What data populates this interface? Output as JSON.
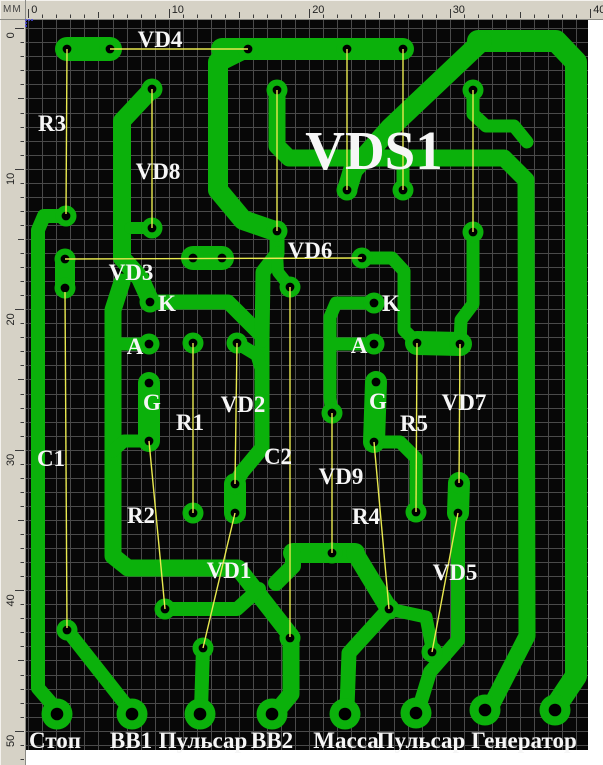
{
  "ruler": {
    "unit": "MM",
    "bg": "#d6d2c6",
    "tick_color": "#3a3a3a",
    "origin_px": 28.2,
    "px_per_mm": 14.05,
    "top_strip_h": 20,
    "left_strip_w": 26,
    "top_marks": [
      0,
      10,
      20,
      30,
      40
    ],
    "left_marks": [
      0,
      10,
      20,
      30,
      40,
      50
    ],
    "top_minor_count": 40,
    "left_minor_count": 52
  },
  "board": {
    "x": 26,
    "y": 20,
    "w": 562,
    "h": 730,
    "bg": "#070707",
    "grid_color": "#4a4a4a",
    "origin_marker_color": "#4646e8"
  },
  "colors": {
    "copper": "#0bb10b",
    "hole": "#000000",
    "ratsnest": "#e9e94f",
    "label": "#f6f6f6"
  },
  "pcb": {
    "title": {
      "text": "VDS1",
      "x": 374,
      "y": 169,
      "size": 55
    },
    "labels": [
      {
        "text": "VD4",
        "x": 160,
        "y": 47
      },
      {
        "text": "R3",
        "x": 52,
        "y": 131
      },
      {
        "text": "VD8",
        "x": 158,
        "y": 179
      },
      {
        "text": "VD3",
        "x": 131,
        "y": 280
      },
      {
        "text": "VD6",
        "x": 310,
        "y": 258
      },
      {
        "text": "K",
        "x": 167,
        "y": 311
      },
      {
        "text": "K",
        "x": 391,
        "y": 311
      },
      {
        "text": "A",
        "x": 135,
        "y": 354
      },
      {
        "text": "A",
        "x": 359,
        "y": 353
      },
      {
        "text": "G",
        "x": 152,
        "y": 410
      },
      {
        "text": "G",
        "x": 378,
        "y": 409
      },
      {
        "text": "R1",
        "x": 190,
        "y": 430
      },
      {
        "text": "VD2",
        "x": 243,
        "y": 412
      },
      {
        "text": "R5",
        "x": 414,
        "y": 431
      },
      {
        "text": "VD7",
        "x": 464,
        "y": 410
      },
      {
        "text": "C1",
        "x": 51,
        "y": 466
      },
      {
        "text": "C2",
        "x": 278,
        "y": 464
      },
      {
        "text": "VD9",
        "x": 341,
        "y": 484
      },
      {
        "text": "R2",
        "x": 141,
        "y": 523
      },
      {
        "text": "R4",
        "x": 366,
        "y": 524
      },
      {
        "text": "VD1",
        "x": 229,
        "y": 578
      },
      {
        "text": "VD5",
        "x": 455,
        "y": 580
      }
    ],
    "connector_labels": [
      {
        "text": "Стоп",
        "x": 55,
        "y": 748
      },
      {
        "text": "BB1",
        "x": 131,
        "y": 748
      },
      {
        "text": "Пульсар",
        "x": 203,
        "y": 748
      },
      {
        "text": "BB2",
        "x": 272,
        "y": 748
      },
      {
        "text": "Масса",
        "x": 346,
        "y": 748
      },
      {
        "text": "Пульсар",
        "x": 421,
        "y": 748
      },
      {
        "text": "Генератор",
        "x": 524,
        "y": 748
      }
    ],
    "pads": [
      [
        67,
        49
      ],
      [
        110,
        49
      ],
      [
        248,
        49
      ],
      [
        347,
        49
      ],
      [
        403,
        49
      ],
      [
        152,
        89
      ],
      [
        277,
        90
      ],
      [
        473,
        90
      ],
      [
        347,
        190
      ],
      [
        403,
        190
      ],
      [
        66,
        216
      ],
      [
        152,
        228
      ],
      [
        277,
        231
      ],
      [
        473,
        232
      ],
      [
        65,
        259
      ],
      [
        65,
        288
      ],
      [
        193,
        258
      ],
      [
        222,
        258
      ],
      [
        362,
        258
      ],
      [
        290,
        287
      ],
      [
        150,
        302
      ],
      [
        374,
        303
      ],
      [
        149,
        344
      ],
      [
        193,
        343
      ],
      [
        237,
        343
      ],
      [
        374,
        344
      ],
      [
        417,
        343
      ],
      [
        460,
        344
      ],
      [
        149,
        383
      ],
      [
        376,
        382
      ],
      [
        332,
        413
      ],
      [
        149,
        441
      ],
      [
        374,
        442
      ],
      [
        235,
        484
      ],
      [
        459,
        483
      ],
      [
        193,
        513
      ],
      [
        235,
        513
      ],
      [
        416,
        512
      ],
      [
        458,
        513
      ],
      [
        332,
        553
      ],
      [
        165,
        609
      ],
      [
        389,
        609
      ],
      [
        67,
        630
      ],
      [
        203,
        648
      ],
      [
        290,
        638
      ],
      [
        432,
        652
      ]
    ],
    "pad_r": 10.5,
    "pad_hole_r": 4.4,
    "big_pads": [
      [
        57,
        714
      ],
      [
        132,
        714
      ],
      [
        200,
        714
      ],
      [
        272,
        714
      ],
      [
        345,
        714
      ],
      [
        416,
        713
      ],
      [
        485,
        710
      ],
      [
        555,
        710
      ]
    ],
    "big_pad_r": 15.5,
    "big_pad_hole_r": 6.3,
    "traces": [
      {
        "p": [
          [
            67,
            49
          ],
          [
            110,
            49
          ]
        ],
        "w": 24
      },
      {
        "p": [
          [
            403,
            49
          ],
          [
            222,
            49
          ]
        ],
        "w": 22
      },
      {
        "p": [
          [
            244,
            49
          ],
          [
            218,
            62
          ],
          [
            218,
            190
          ],
          [
            243,
            220
          ],
          [
            272,
            230
          ]
        ],
        "w": 20
      },
      {
        "p": [
          [
            152,
            89
          ],
          [
            122,
            121
          ],
          [
            122,
            258
          ],
          [
            140,
            278
          ],
          [
            150,
            300
          ]
        ],
        "w": 18
      },
      {
        "p": [
          [
            122,
            282
          ],
          [
            113,
            310
          ],
          [
            113,
            556
          ],
          [
            128,
            568
          ],
          [
            238,
            568
          ],
          [
            291,
            636
          ],
          [
            291,
            694
          ],
          [
            277,
            711
          ]
        ],
        "w": 17
      },
      {
        "p": [
          [
            113,
            344
          ],
          [
            149,
            344
          ]
        ],
        "w": 13
      },
      {
        "p": [
          [
            149,
            441
          ],
          [
            124,
            441
          ],
          [
            113,
            451
          ]
        ],
        "w": 13
      },
      {
        "p": [
          [
            149,
            383
          ],
          [
            149,
            441
          ]
        ],
        "w": 22
      },
      {
        "p": [
          [
            376,
            382
          ],
          [
            374,
            442
          ]
        ],
        "w": 22
      },
      {
        "p": [
          [
            66,
            216
          ],
          [
            44,
            216
          ],
          [
            38,
            230
          ],
          [
            38,
            688
          ],
          [
            57,
            710
          ]
        ],
        "w": 14
      },
      {
        "p": [
          [
            65,
            259
          ],
          [
            65,
            288
          ]
        ],
        "w": 20
      },
      {
        "p": [
          [
            193,
            258
          ],
          [
            222,
            258
          ]
        ],
        "w": 24
      },
      {
        "p": [
          [
            152,
            228
          ],
          [
            130,
            228
          ]
        ],
        "w": 12
      },
      {
        "p": [
          [
            150,
            302
          ],
          [
            228,
            302
          ],
          [
            262,
            336
          ],
          [
            262,
            448
          ],
          [
            242,
            472
          ],
          [
            235,
            484
          ]
        ],
        "w": 15
      },
      {
        "p": [
          [
            277,
            231
          ],
          [
            277,
            254
          ],
          [
            263,
            272
          ],
          [
            262,
            340
          ]
        ],
        "w": 15
      },
      {
        "p": [
          [
            290,
            287
          ],
          [
            278,
            272
          ],
          [
            277,
            252
          ]
        ],
        "w": 12
      },
      {
        "p": [
          [
            237,
            343
          ],
          [
            257,
            355
          ],
          [
            262,
            372
          ]
        ],
        "w": 13
      },
      {
        "p": [
          [
            235,
            484
          ],
          [
            235,
            513
          ]
        ],
        "w": 22
      },
      {
        "p": [
          [
            277,
            90
          ],
          [
            277,
            146
          ],
          [
            289,
            158
          ],
          [
            504,
            158
          ],
          [
            526,
            180
          ],
          [
            527,
            636
          ],
          [
            492,
            704
          ]
        ],
        "w": 17
      },
      {
        "p": [
          [
            473,
            90
          ],
          [
            473,
            114
          ],
          [
            486,
            126
          ],
          [
            514,
            126
          ],
          [
            527,
            142
          ]
        ],
        "w": 13
      },
      {
        "p": [
          [
            478,
            41
          ],
          [
            556,
            41
          ],
          [
            576,
            62
          ],
          [
            576,
            676
          ],
          [
            558,
            703
          ]
        ],
        "w": 22
      },
      {
        "p": [
          [
            482,
            41
          ],
          [
            390,
            128
          ],
          [
            353,
            170
          ],
          [
            347,
            190
          ]
        ],
        "w": 20
      },
      {
        "p": [
          [
            403,
            190
          ],
          [
            403,
            158
          ]
        ],
        "w": 13
      },
      {
        "p": [
          [
            362,
            258
          ],
          [
            392,
            258
          ],
          [
            404,
            271
          ],
          [
            404,
            330
          ],
          [
            417,
            343
          ]
        ],
        "w": 13
      },
      {
        "p": [
          [
            473,
            232
          ],
          [
            473,
            304
          ],
          [
            461,
            320
          ],
          [
            460,
            344
          ]
        ],
        "w": 13
      },
      {
        "p": [
          [
            417,
            343
          ],
          [
            460,
            344
          ]
        ],
        "w": 24
      },
      {
        "p": [
          [
            374,
            303
          ],
          [
            336,
            303
          ],
          [
            330,
            317
          ],
          [
            330,
            398
          ],
          [
            332,
            413
          ]
        ],
        "w": 13
      },
      {
        "p": [
          [
            330,
            344
          ],
          [
            374,
            344
          ]
        ],
        "w": 13
      },
      {
        "p": [
          [
            374,
            442
          ],
          [
            400,
            442
          ],
          [
            416,
            458
          ],
          [
            416,
            512
          ]
        ],
        "w": 13
      },
      {
        "p": [
          [
            459,
            483
          ],
          [
            458,
            513
          ]
        ],
        "w": 22
      },
      {
        "p": [
          [
            458,
            513
          ],
          [
            458,
            640
          ],
          [
            430,
            672
          ],
          [
            419,
            708
          ]
        ],
        "w": 14
      },
      {
        "p": [
          [
            293,
            553
          ],
          [
            355,
            553
          ]
        ],
        "w": 20
      },
      {
        "p": [
          [
            293,
            553
          ],
          [
            293,
            566
          ],
          [
            276,
            583
          ]
        ],
        "w": 16
      },
      {
        "p": [
          [
            165,
            609
          ],
          [
            237,
            609
          ],
          [
            259,
            589
          ]
        ],
        "w": 14
      },
      {
        "p": [
          [
            355,
            553
          ],
          [
            389,
            609
          ]
        ],
        "w": 18
      },
      {
        "p": [
          [
            389,
            609
          ],
          [
            349,
            653
          ],
          [
            347,
            708
          ]
        ],
        "w": 15
      },
      {
        "p": [
          [
            389,
            609
          ],
          [
            426,
            617
          ],
          [
            432,
            648
          ]
        ],
        "w": 13
      },
      {
        "p": [
          [
            67,
            630
          ],
          [
            130,
            710
          ]
        ],
        "w": 14
      },
      {
        "p": [
          [
            203,
            648
          ],
          [
            201,
            710
          ]
        ],
        "w": 14
      }
    ],
    "ratsnest": [
      [
        [
          110,
          49
        ],
        [
          248,
          49
        ]
      ],
      [
        [
          67,
          49
        ],
        [
          66,
          214
        ]
      ],
      [
        [
          152,
          89
        ],
        [
          152,
          228
        ]
      ],
      [
        [
          277,
          90
        ],
        [
          277,
          231
        ]
      ],
      [
        [
          347,
          49
        ],
        [
          347,
          190
        ]
      ],
      [
        [
          403,
          49
        ],
        [
          403,
          190
        ]
      ],
      [
        [
          473,
          90
        ],
        [
          473,
          232
        ]
      ],
      [
        [
          65,
          259
        ],
        [
          362,
          258
        ]
      ],
      [
        [
          193,
          343
        ],
        [
          193,
          513
        ]
      ],
      [
        [
          237,
          343
        ],
        [
          235,
          484
        ]
      ],
      [
        [
          417,
          343
        ],
        [
          416,
          512
        ]
      ],
      [
        [
          460,
          344
        ],
        [
          459,
          483
        ]
      ],
      [
        [
          65,
          292
        ],
        [
          67,
          628
        ]
      ],
      [
        [
          290,
          287
        ],
        [
          290,
          637
        ]
      ],
      [
        [
          332,
          413
        ],
        [
          332,
          553
        ]
      ],
      [
        [
          149,
          441
        ],
        [
          165,
          609
        ]
      ],
      [
        [
          374,
          442
        ],
        [
          389,
          609
        ]
      ],
      [
        [
          235,
          513
        ],
        [
          203,
          648
        ]
      ],
      [
        [
          458,
          513
        ],
        [
          432,
          652
        ]
      ]
    ]
  }
}
